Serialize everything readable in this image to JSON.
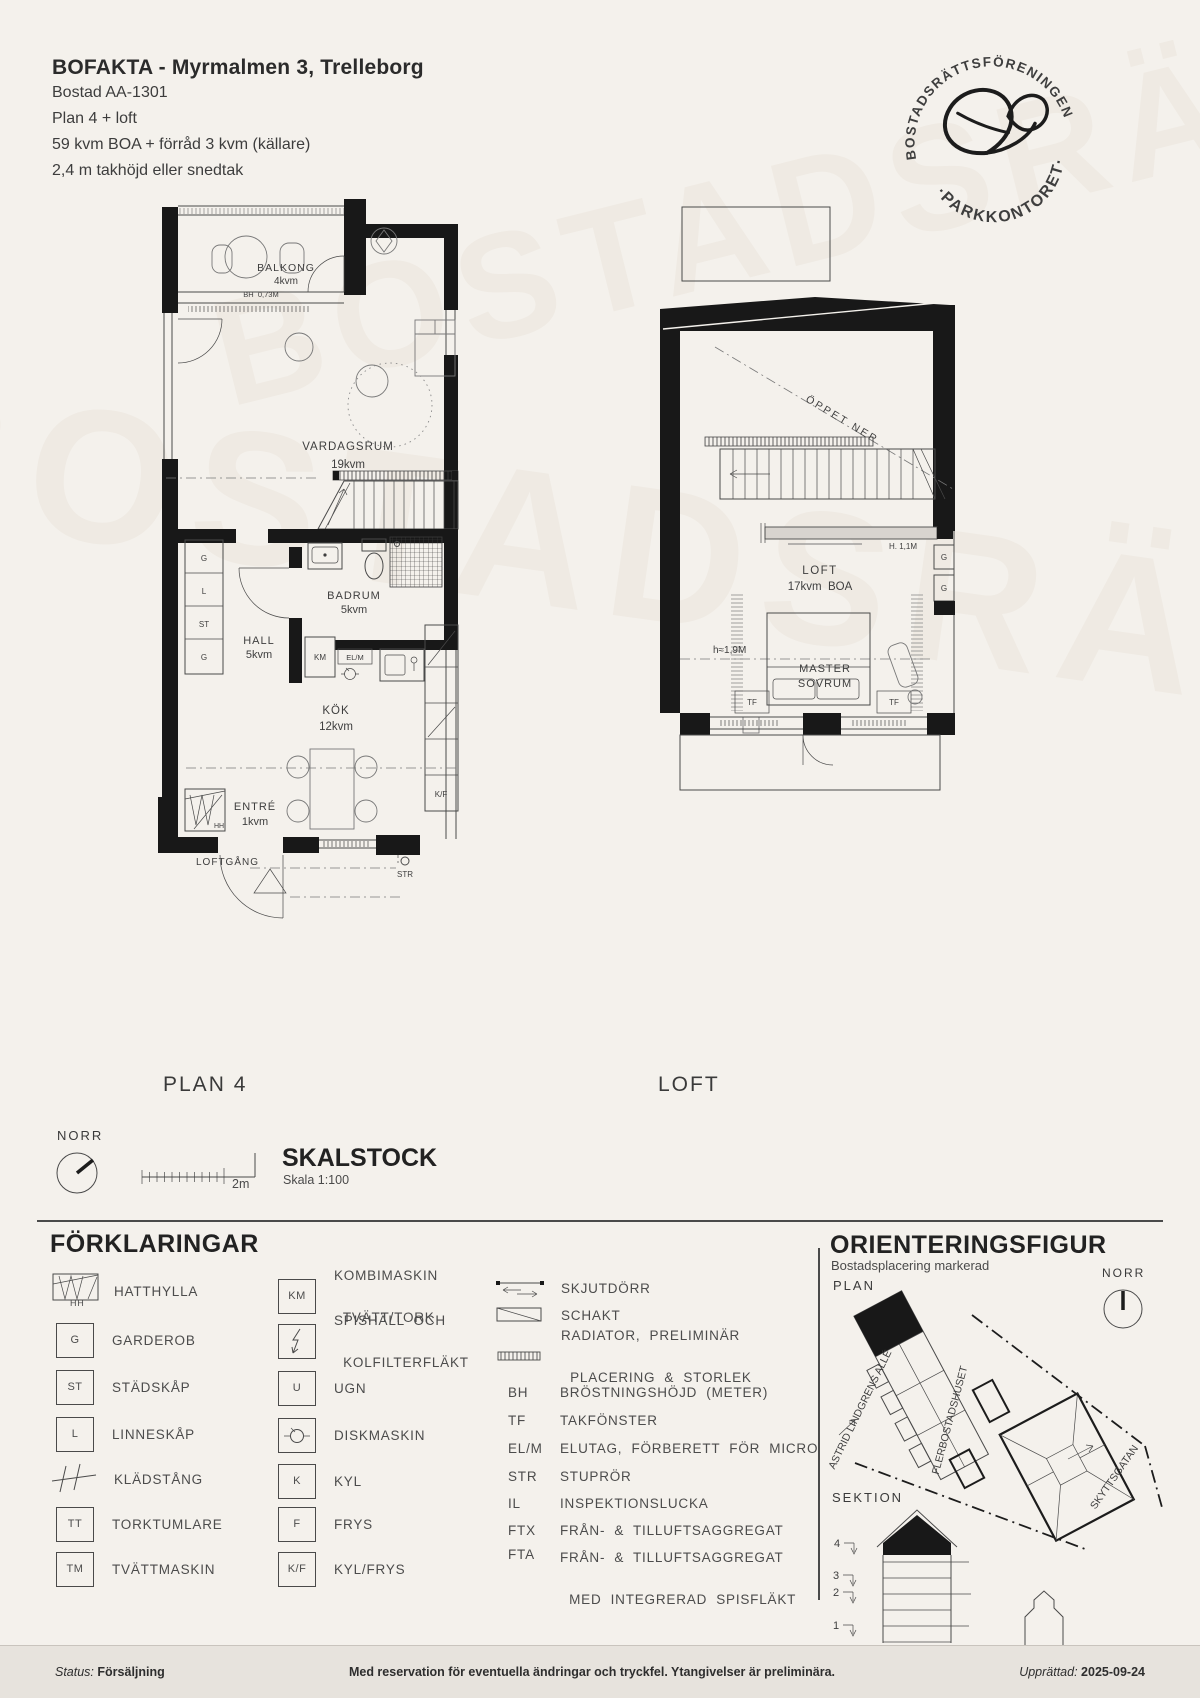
{
  "watermark": "BOSTADSRÄTTSFÖRENINGEN",
  "header": {
    "title": "BOFAKTA - Myrmalmen 3, Trelleborg",
    "line1": "Bostad AA-1301",
    "line2": "Plan 4 + loft",
    "line3": "59 kvm BOA + förråd 3 kvm (källare)",
    "line4": "2,4 m takhöjd eller snedtak"
  },
  "logo": {
    "arc_top": "BOSTADSRÄTTSFÖRENINGEN",
    "arc_bottom": "·PARKKONTORET·"
  },
  "plan4": {
    "caption": "PLAN 4",
    "balkong": "BALKONG",
    "balkong_area": "4kvm",
    "bh": "BH  0,73M",
    "vardagsrum": "VARDAGSRUM",
    "vardagsrum_area": "19kvm",
    "badrum": "BADRUM",
    "badrum_area": "5kvm",
    "hall": "HALL",
    "hall_area": "5kvm",
    "kok": "KÖK",
    "kok_area": "12kvm",
    "entre": "ENTRÉ",
    "entre_area": "1kvm",
    "loftgang": "LOFTGÅNG",
    "g1": "G",
    "l": "L",
    "st": "ST",
    "g2": "G",
    "km": "KM",
    "elm": "EL/M",
    "hh": "HH",
    "kf": "K/F",
    "str": "STR"
  },
  "loft": {
    "caption": "LOFT",
    "oppet_ner": "ÖPPET NER",
    "h11": "H. 1,1M",
    "name": "LOFT",
    "area": "17kvm  BOA",
    "h19": "h≈1,9M",
    "master1": "MASTER",
    "master2": "SOVRUM",
    "tf1": "TF",
    "tf2": "TF",
    "g1": "G",
    "g2": "G"
  },
  "scalebar": {
    "norr": "NORR",
    "title": "SKALSTOCK",
    "scale": "Skala 1:100",
    "length": "2m"
  },
  "legend": {
    "heading": "FÖRKLARINGAR",
    "col1": [
      {
        "sym": "HH",
        "label": "HATTHYLLA"
      },
      {
        "sym": "G",
        "label": "GARDEROB"
      },
      {
        "sym": "ST",
        "label": "STÄDSKÅP"
      },
      {
        "sym": "L",
        "label": "LINNESKÅP"
      },
      {
        "sym": "",
        "label": "KLÄDSTÅNG"
      },
      {
        "sym": "TT",
        "label": "TORKTUMLARE"
      },
      {
        "sym": "TM",
        "label": "TVÄTTMASKIN"
      }
    ],
    "col2": [
      {
        "sym": "KM",
        "line1": "KOMBIMASKIN",
        "line2": "TVÄTT/TORK"
      },
      {
        "sym": "",
        "line1": "SPISHÄLL  OCH",
        "line2": "KOLFILTERFLÄKT"
      },
      {
        "sym": "U",
        "line1": "UGN",
        "line2": ""
      },
      {
        "sym": "",
        "line1": "DISKMASKIN",
        "line2": ""
      },
      {
        "sym": "K",
        "line1": "KYL",
        "line2": ""
      },
      {
        "sym": "F",
        "line1": "FRYS",
        "line2": ""
      },
      {
        "sym": "K/F",
        "line1": "KYL/FRYS",
        "line2": ""
      }
    ],
    "col3_symbols": [
      {
        "line1": "SKJUTDÖRR",
        "line2": ""
      },
      {
        "line1": "SCHAKT",
        "line2": ""
      },
      {
        "line1": "RADIATOR,  PRELIMINÄR",
        "line2": "PLACERING  &  STORLEK"
      }
    ],
    "abbr": [
      {
        "abbr": "BH",
        "line1": "BRÖSTNINGSHÖJD  (METER)",
        "line2": ""
      },
      {
        "abbr": "TF",
        "line1": "TAKFÖNSTER",
        "line2": ""
      },
      {
        "abbr": "EL/M",
        "line1": "ELUTAG,  FÖRBERETT  FÖR  MICRO",
        "line2": ""
      },
      {
        "abbr": "STR",
        "line1": "STUPRÖR",
        "line2": ""
      },
      {
        "abbr": "IL",
        "line1": "INSPEKTIONSLUCKA",
        "line2": ""
      },
      {
        "abbr": "FTX",
        "line1": "FRÅN-  &  TILLUFTSAGGREGAT",
        "line2": ""
      },
      {
        "abbr": "FTA",
        "line1": "FRÅN-  &  TILLUFTSAGGREGAT",
        "line2": "MED  INTEGRERAD  SPISFLÄKT"
      }
    ]
  },
  "orientation": {
    "heading": "ORIENTERINGSFIGUR",
    "sub": "Bostadsplacering markerad",
    "plan": "PLAN",
    "norr": "NORR",
    "sektion": "SEKTION",
    "street1": "ASTRID LINDGRENS ALLÉ",
    "building": "FLERBOSTADSHUSET",
    "street2": "SKYTTSGATAN",
    "floors": [
      "4",
      "3",
      "2",
      "1"
    ]
  },
  "footer": {
    "status_label": "Status:",
    "status_value": "Försäljning",
    "disclaimer": "Med reservation för eventuella ändringar och tryckfel. Ytangivelser är preliminära.",
    "created_label": "Upprättad:",
    "created_value": "2025-09-24"
  }
}
